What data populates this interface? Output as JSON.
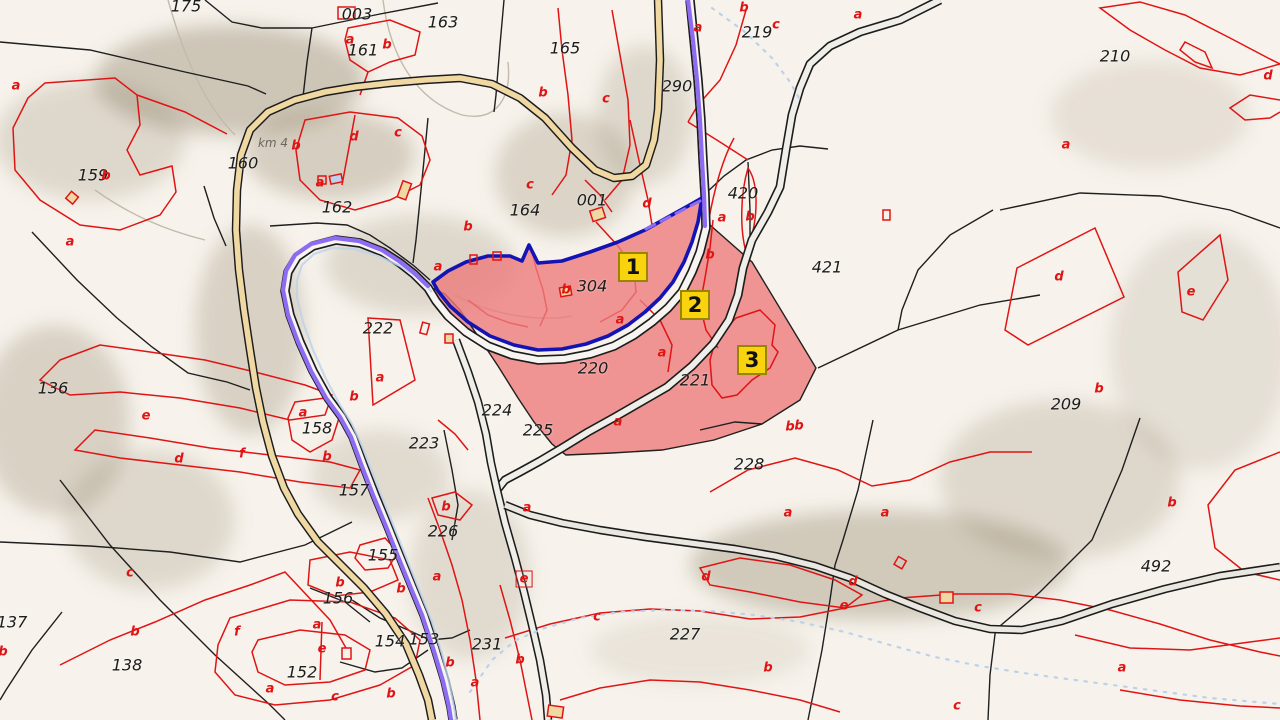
{
  "map": {
    "type": "cadastral-parcel-map",
    "colors": {
      "background": "#f6f2ea",
      "terrain_shade": "#8a7a5e",
      "highlight_parcel_fill": "#ec7c7c",
      "selected_parcel_border": "#1414b4",
      "route_line": "#8d6cf2",
      "road_tan_fill": "#f0d8a2",
      "road_light_fill": "#f6f5f1",
      "boundary_black": "#1f1f1f",
      "boundary_red": "#e01414",
      "stream_blue": "#bcd2ea",
      "marker_bg": "#f8d30e",
      "marker_border": "#9a8500"
    },
    "markers": [
      {
        "label": "1",
        "x": 633,
        "y": 267
      },
      {
        "label": "2",
        "x": 695,
        "y": 305
      },
      {
        "label": "3",
        "x": 752,
        "y": 360
      }
    ],
    "parcel_labels": [
      {
        "text": "175",
        "x": 186,
        "y": 6
      },
      {
        "text": "003",
        "x": 357,
        "y": 14
      },
      {
        "text": "163",
        "x": 443,
        "y": 22
      },
      {
        "text": "161",
        "x": 363,
        "y": 50
      },
      {
        "text": "165",
        "x": 565,
        "y": 48
      },
      {
        "text": "290",
        "x": 677,
        "y": 86
      },
      {
        "text": "219",
        "x": 757,
        "y": 32
      },
      {
        "text": "210",
        "x": 1115,
        "y": 56
      },
      {
        "text": "159",
        "x": 93,
        "y": 175
      },
      {
        "text": "160",
        "x": 243,
        "y": 163
      },
      {
        "text": "162",
        "x": 337,
        "y": 207
      },
      {
        "text": "164",
        "x": 525,
        "y": 210
      },
      {
        "text": "001",
        "x": 592,
        "y": 200
      },
      {
        "text": "420",
        "x": 743,
        "y": 193
      },
      {
        "text": "421",
        "x": 827,
        "y": 267
      },
      {
        "text": "304",
        "x": 592,
        "y": 286
      },
      {
        "text": "136",
        "x": 53,
        "y": 388
      },
      {
        "text": "222",
        "x": 378,
        "y": 328
      },
      {
        "text": "158",
        "x": 317,
        "y": 428
      },
      {
        "text": "223",
        "x": 424,
        "y": 443
      },
      {
        "text": "224",
        "x": 497,
        "y": 410
      },
      {
        "text": "225",
        "x": 538,
        "y": 430
      },
      {
        "text": "220",
        "x": 593,
        "y": 368
      },
      {
        "text": "221",
        "x": 695,
        "y": 380
      },
      {
        "text": "228",
        "x": 749,
        "y": 464
      },
      {
        "text": "209",
        "x": 1066,
        "y": 404
      },
      {
        "text": "492",
        "x": 1156,
        "y": 566
      },
      {
        "text": "157",
        "x": 354,
        "y": 490
      },
      {
        "text": "155",
        "x": 383,
        "y": 555
      },
      {
        "text": "156",
        "x": 338,
        "y": 598
      },
      {
        "text": "154",
        "x": 390,
        "y": 641
      },
      {
        "text": "153",
        "x": 424,
        "y": 639
      },
      {
        "text": "152",
        "x": 302,
        "y": 672
      },
      {
        "text": "137",
        "x": 12,
        "y": 622
      },
      {
        "text": "138",
        "x": 127,
        "y": 665
      },
      {
        "text": "231",
        "x": 487,
        "y": 644
      },
      {
        "text": "226",
        "x": 443,
        "y": 531
      },
      {
        "text": "227",
        "x": 685,
        "y": 634
      }
    ],
    "special_labels": [
      {
        "text": "km 4",
        "x": 273,
        "y": 143
      }
    ],
    "subparcel_letters": [
      {
        "t": "a",
        "x": 16,
        "y": 86
      },
      {
        "t": "a",
        "x": 70,
        "y": 242
      },
      {
        "t": "b",
        "x": 106,
        "y": 176
      },
      {
        "t": "a",
        "x": 350,
        "y": 40
      },
      {
        "t": "b",
        "x": 387,
        "y": 45
      },
      {
        "t": "d",
        "x": 354,
        "y": 137
      },
      {
        "t": "c",
        "x": 398,
        "y": 133
      },
      {
        "t": "b",
        "x": 296,
        "y": 146
      },
      {
        "t": "a",
        "x": 320,
        "y": 183
      },
      {
        "t": "b",
        "x": 543,
        "y": 93
      },
      {
        "t": "c",
        "x": 606,
        "y": 99
      },
      {
        "t": "c",
        "x": 530,
        "y": 185
      },
      {
        "t": "a",
        "x": 698,
        "y": 28
      },
      {
        "t": "b",
        "x": 744,
        "y": 8
      },
      {
        "t": "c",
        "x": 776,
        "y": 25
      },
      {
        "t": "a",
        "x": 858,
        "y": 15
      },
      {
        "t": "a",
        "x": 1066,
        "y": 145
      },
      {
        "t": "d",
        "x": 1268,
        "y": 76
      },
      {
        "t": "d",
        "x": 1059,
        "y": 277
      },
      {
        "t": "e",
        "x": 1191,
        "y": 292
      },
      {
        "t": "b",
        "x": 1099,
        "y": 389
      },
      {
        "t": "e",
        "x": 146,
        "y": 416
      },
      {
        "t": "d",
        "x": 179,
        "y": 459
      },
      {
        "t": "f",
        "x": 242,
        "y": 454
      },
      {
        "t": "a",
        "x": 303,
        "y": 413
      },
      {
        "t": "b",
        "x": 327,
        "y": 457
      },
      {
        "t": "b",
        "x": 354,
        "y": 397
      },
      {
        "t": "a",
        "x": 380,
        "y": 378
      },
      {
        "t": "c",
        "x": 130,
        "y": 573
      },
      {
        "t": "b",
        "x": 3,
        "y": 652
      },
      {
        "t": "b",
        "x": 135,
        "y": 632
      },
      {
        "t": "b",
        "x": 340,
        "y": 583
      },
      {
        "t": "a",
        "x": 317,
        "y": 625
      },
      {
        "t": "e",
        "x": 322,
        "y": 649
      },
      {
        "t": "a",
        "x": 270,
        "y": 689
      },
      {
        "t": "c",
        "x": 335,
        "y": 697
      },
      {
        "t": "f",
        "x": 237,
        "y": 632
      },
      {
        "t": "b",
        "x": 446,
        "y": 507
      },
      {
        "t": "a",
        "x": 527,
        "y": 508
      },
      {
        "t": "a",
        "x": 437,
        "y": 577
      },
      {
        "t": "b",
        "x": 401,
        "y": 589
      },
      {
        "t": "b",
        "x": 520,
        "y": 660
      },
      {
        "t": "a",
        "x": 475,
        "y": 683
      },
      {
        "t": "b",
        "x": 391,
        "y": 694
      },
      {
        "t": "b",
        "x": 450,
        "y": 663
      },
      {
        "t": "d",
        "x": 706,
        "y": 577
      },
      {
        "t": "c",
        "x": 597,
        "y": 617
      },
      {
        "t": "b",
        "x": 768,
        "y": 668
      },
      {
        "t": "c",
        "x": 957,
        "y": 706
      },
      {
        "t": "a",
        "x": 1122,
        "y": 668
      },
      {
        "t": "b",
        "x": 790,
        "y": 427
      },
      {
        "t": "a",
        "x": 788,
        "y": 513
      },
      {
        "t": "a",
        "x": 885,
        "y": 513
      },
      {
        "t": "d",
        "x": 853,
        "y": 582
      },
      {
        "t": "e",
        "x": 844,
        "y": 606
      },
      {
        "t": "c",
        "x": 978,
        "y": 608
      },
      {
        "t": "b",
        "x": 1172,
        "y": 503
      },
      {
        "t": "d",
        "x": 647,
        "y": 204
      },
      {
        "t": "b",
        "x": 468,
        "y": 227
      },
      {
        "t": "a",
        "x": 438,
        "y": 267
      },
      {
        "t": "b",
        "x": 566,
        "y": 290
      },
      {
        "t": "a",
        "x": 620,
        "y": 320
      },
      {
        "t": "a",
        "x": 662,
        "y": 353
      },
      {
        "t": "b",
        "x": 710,
        "y": 255
      },
      {
        "t": "a",
        "x": 722,
        "y": 218
      },
      {
        "t": "b",
        "x": 750,
        "y": 217
      },
      {
        "t": "a",
        "x": 618,
        "y": 422
      },
      {
        "t": "b",
        "x": 799,
        "y": 426
      }
    ],
    "boxed_letters": [
      {
        "t": "e",
        "x": 524,
        "y": 579
      }
    ]
  }
}
